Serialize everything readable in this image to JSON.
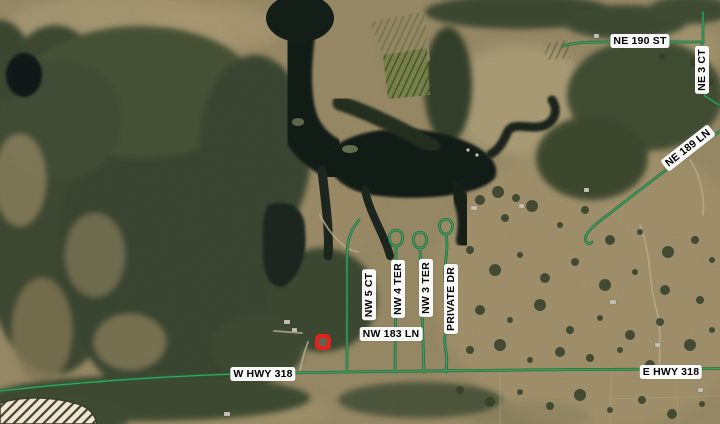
{
  "map": {
    "description": "Aerial imagery map with road name overlay",
    "road_labels": {
      "ne_190_st": "NE 190 ST",
      "ne_3_ct": "NE 3 CT",
      "ne_189_ln": "NE 189 LN",
      "nw_5_ct": "NW 5 CT",
      "nw_4_ter": "NW 4 TER",
      "nw_3_ter": "NW 3 TER",
      "private_dr": "PRIVATE DR",
      "nw_183_ln": "NW 183 LN",
      "w_hwy_318": "W HWY 318",
      "e_hwy_318": "E HWY 318"
    },
    "marker": {
      "kind": "selected-location",
      "color": "#e3231a"
    },
    "colors": {
      "road_line_green": "#2e8b4f",
      "label_background": "#ffffff",
      "label_text": "#000000",
      "water_dark": "#18241d",
      "field_tan": "#b2a177",
      "forest_green": "#49573b",
      "no_data_hatch_fill": "#eee6d2",
      "no_data_hatch_line": "#43402f"
    }
  }
}
